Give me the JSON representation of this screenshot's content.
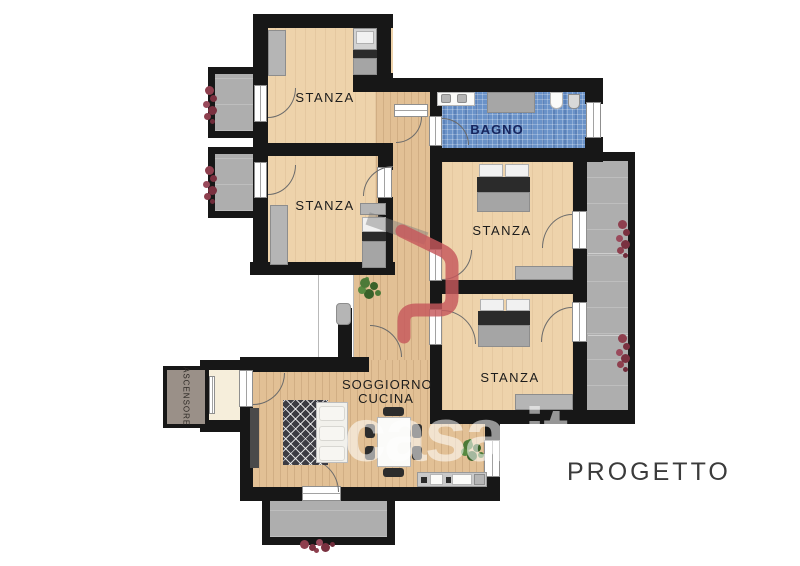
{
  "plan": {
    "rooms": {
      "stanza1": {
        "label": "STANZA"
      },
      "stanza2": {
        "label": "STANZA"
      },
      "stanza3": {
        "label": "STANZA"
      },
      "stanza4": {
        "label": "STANZA"
      },
      "bagno": {
        "label": "BAGNO"
      },
      "soggiorno": {
        "label_line1": "SOGGIORNO",
        "label_line2": "CUCINA"
      },
      "ascensore": {
        "label": "ASCENSORE"
      }
    },
    "caption": {
      "label": "PROGETTO"
    },
    "watermark": {
      "text": "casa.it"
    },
    "colors": {
      "wall": "#171717",
      "room_floor": "#eed3ab",
      "plank_floor": "#e2c095",
      "bathroom_tile": "#6a92c8",
      "balcony": "#aeaeae",
      "logo_red": "#c6585c",
      "plant_red": "#8e3f4e",
      "plant_green": "#4c7a38"
    }
  }
}
